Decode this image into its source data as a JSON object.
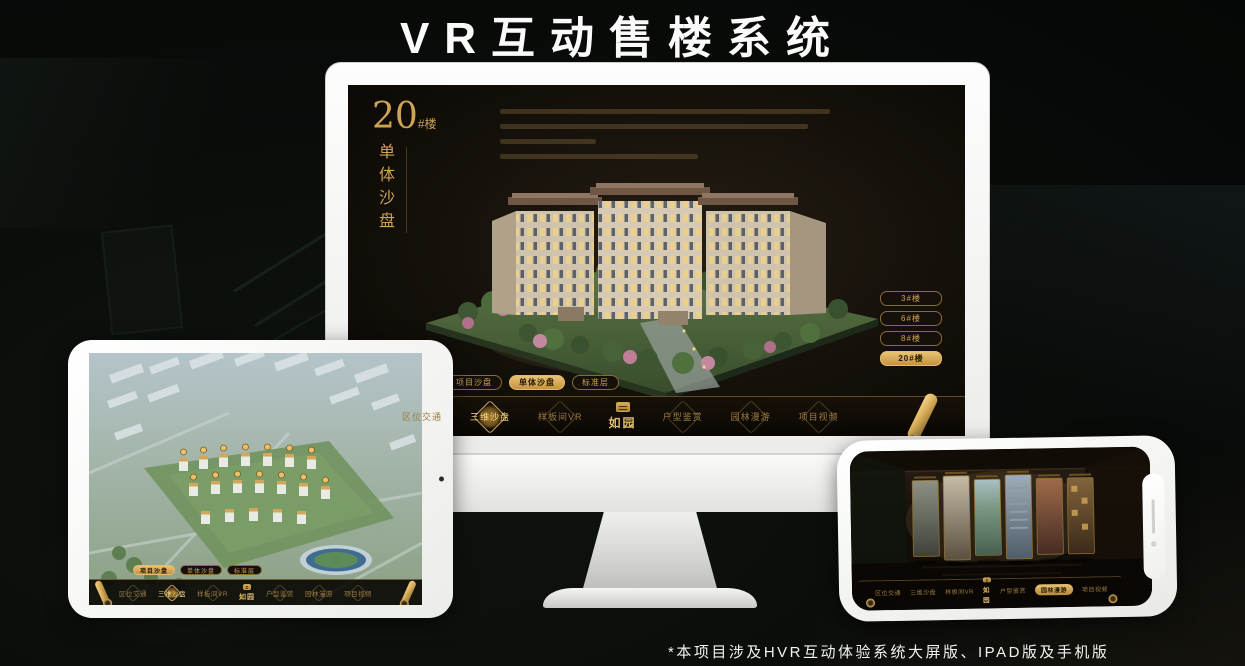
{
  "page": {
    "title": "VR互动售楼系统",
    "footnote": "*本项目涉及HVR互动体验系统大屏版、IPAD版及手机版"
  },
  "colors": {
    "accent_gold": "#d2a75a",
    "accent_gold_bright": "#f5d98b",
    "accent_gold_dark": "#8a6d35",
    "screen_background": "#14100a"
  },
  "brand": {
    "logo": "如园"
  },
  "desktop": {
    "header": {
      "number": "20",
      "suffix": "#楼",
      "subtitle": "单体沙盘"
    },
    "floor_buttons": [
      {
        "label": "3#楼",
        "active": false
      },
      {
        "label": "6#楼",
        "active": false
      },
      {
        "label": "8#楼",
        "active": false
      },
      {
        "label": "20#楼",
        "active": true
      }
    ],
    "sub_tabs": [
      {
        "label": "项目沙盘",
        "active": false
      },
      {
        "label": "单体沙盘",
        "active": true
      },
      {
        "label": "标准层",
        "active": false
      }
    ],
    "nav": [
      {
        "label": "区位交通",
        "active": false
      },
      {
        "label": "三维沙盘",
        "active": true
      },
      {
        "label": "样板间VR",
        "active": false
      },
      {
        "label": "户型鉴赏",
        "active": false
      },
      {
        "label": "园林漫游",
        "active": false
      },
      {
        "label": "项目视频",
        "active": false
      }
    ]
  },
  "tablet": {
    "sub_tabs": [
      {
        "label": "项目沙盘",
        "active": true
      },
      {
        "label": "单体沙盘",
        "active": false
      },
      {
        "label": "标准层",
        "active": false
      }
    ],
    "nav": [
      {
        "label": "区位交通",
        "active": false
      },
      {
        "label": "三维沙盘",
        "active": true
      },
      {
        "label": "样板间VR",
        "active": false
      },
      {
        "label": "户型鉴赏",
        "active": false
      },
      {
        "label": "园林漫游",
        "active": false
      },
      {
        "label": "项目视频",
        "active": false
      }
    ]
  },
  "phone": {
    "nav": [
      {
        "label": "区位交通",
        "active": false
      },
      {
        "label": "三维沙盘",
        "active": false
      },
      {
        "label": "样板间VR",
        "active": false
      },
      {
        "label": "户型鉴赏",
        "active": false
      },
      {
        "label": "园林漫游",
        "active": true
      },
      {
        "label": "项目视频",
        "active": false
      }
    ]
  }
}
